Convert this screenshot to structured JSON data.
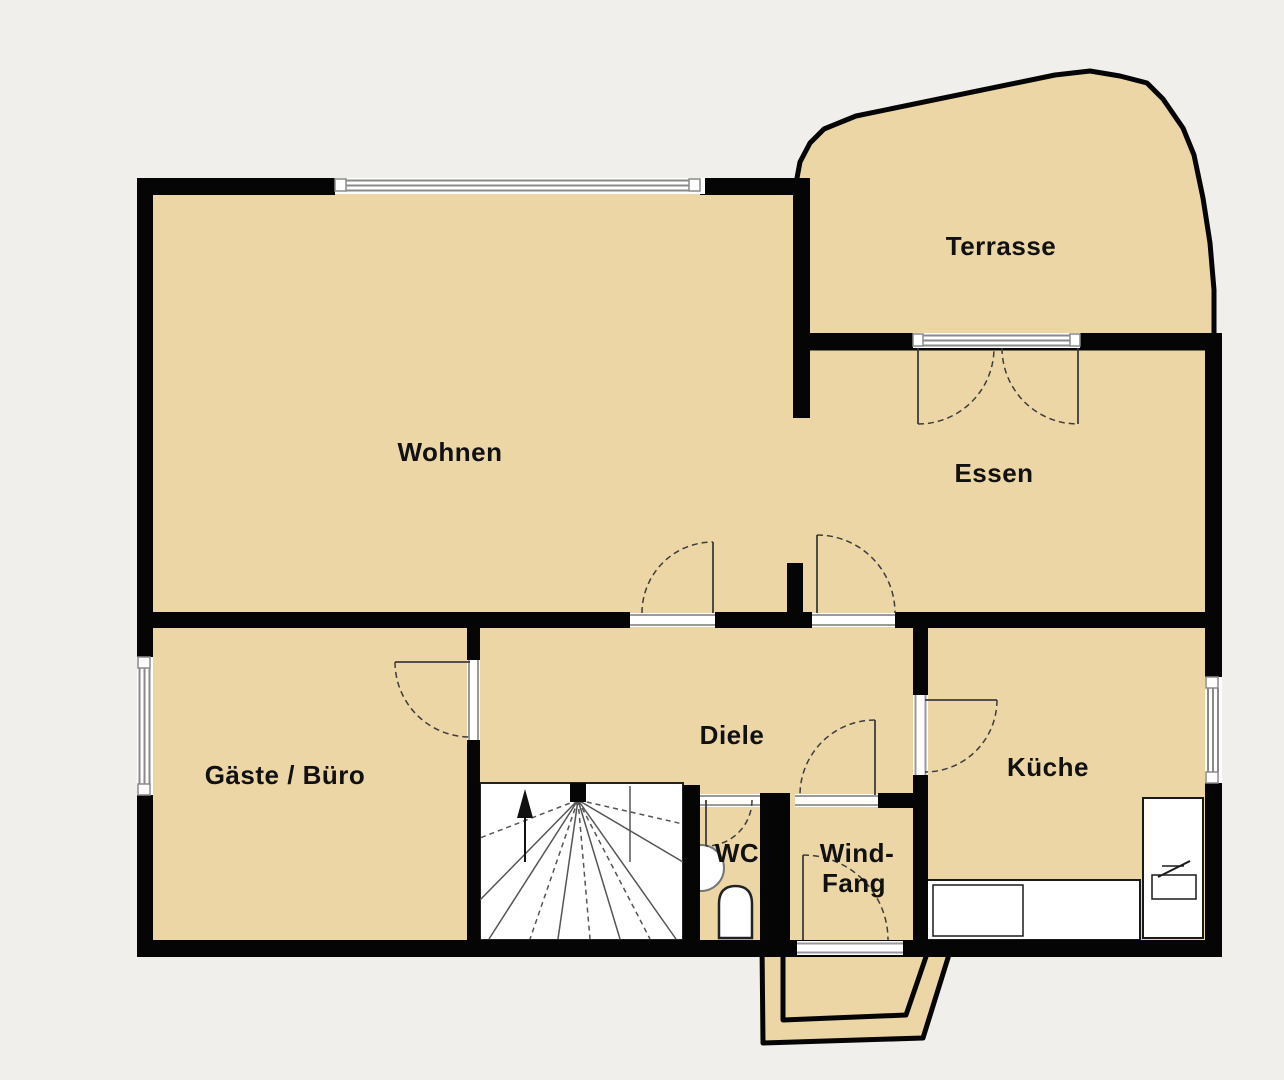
{
  "plan": {
    "rooms": {
      "wohnen": "Wohnen",
      "terrasse": "Terrasse",
      "essen": "Essen",
      "gaeste_buero": "Gäste / Büro",
      "diele": "Diele",
      "kueche": "Küche",
      "wc": "WC",
      "windfang_line1": "Wind-",
      "windfang_line2": "Fang"
    },
    "colors": {
      "background": "#f1efec",
      "floor": "#ecd6a6",
      "wall": "#050505",
      "window_line": "#8a8a8a",
      "door_line": "#3c3c3c",
      "fixture_white": "#ffffff"
    }
  }
}
